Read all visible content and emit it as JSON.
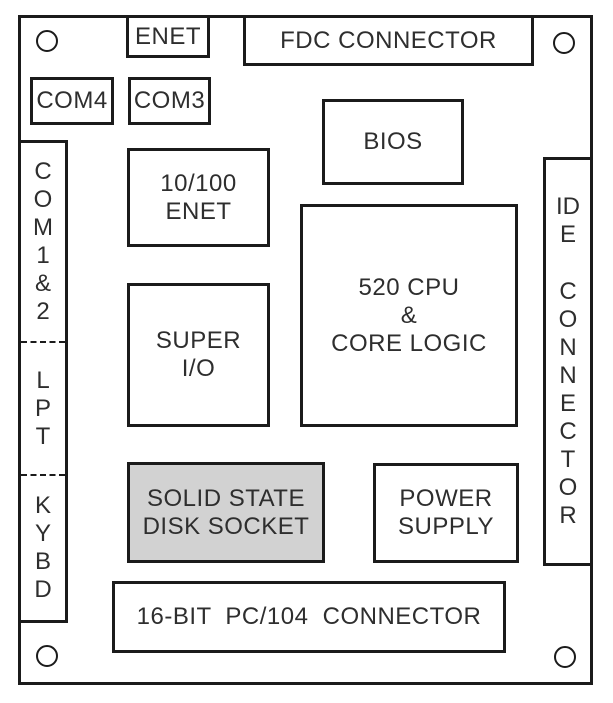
{
  "diagram": {
    "name": "single-board-computer-layout",
    "colors": {
      "line": "#1b1b1b",
      "text": "#2e2e2e",
      "solid_state_disk_fill": "#d2d2d2",
      "background": "#ffffff"
    },
    "blocks": {
      "enet": "ENET",
      "fdc_connector": "FDC CONNECTOR",
      "com4": "COM4",
      "com3": "COM3",
      "bios": "BIOS",
      "enet_10_100": "10/100\nENET",
      "cpu_core_logic": "520 CPU\n&\nCORE LOGIC",
      "super_io": "SUPER\nI/O",
      "solid_state_disk": "SOLID STATE\nDISK SOCKET",
      "power_supply": "POWER\nSUPPLY",
      "pc104_connector": "16-BIT PC/104 CONNECTOR"
    },
    "left_connector": {
      "segments": [
        "COM1&2",
        "LPT",
        "KYBD"
      ]
    },
    "ide_connector": {
      "lines": [
        "IDE",
        "CONNECTOR"
      ]
    }
  }
}
